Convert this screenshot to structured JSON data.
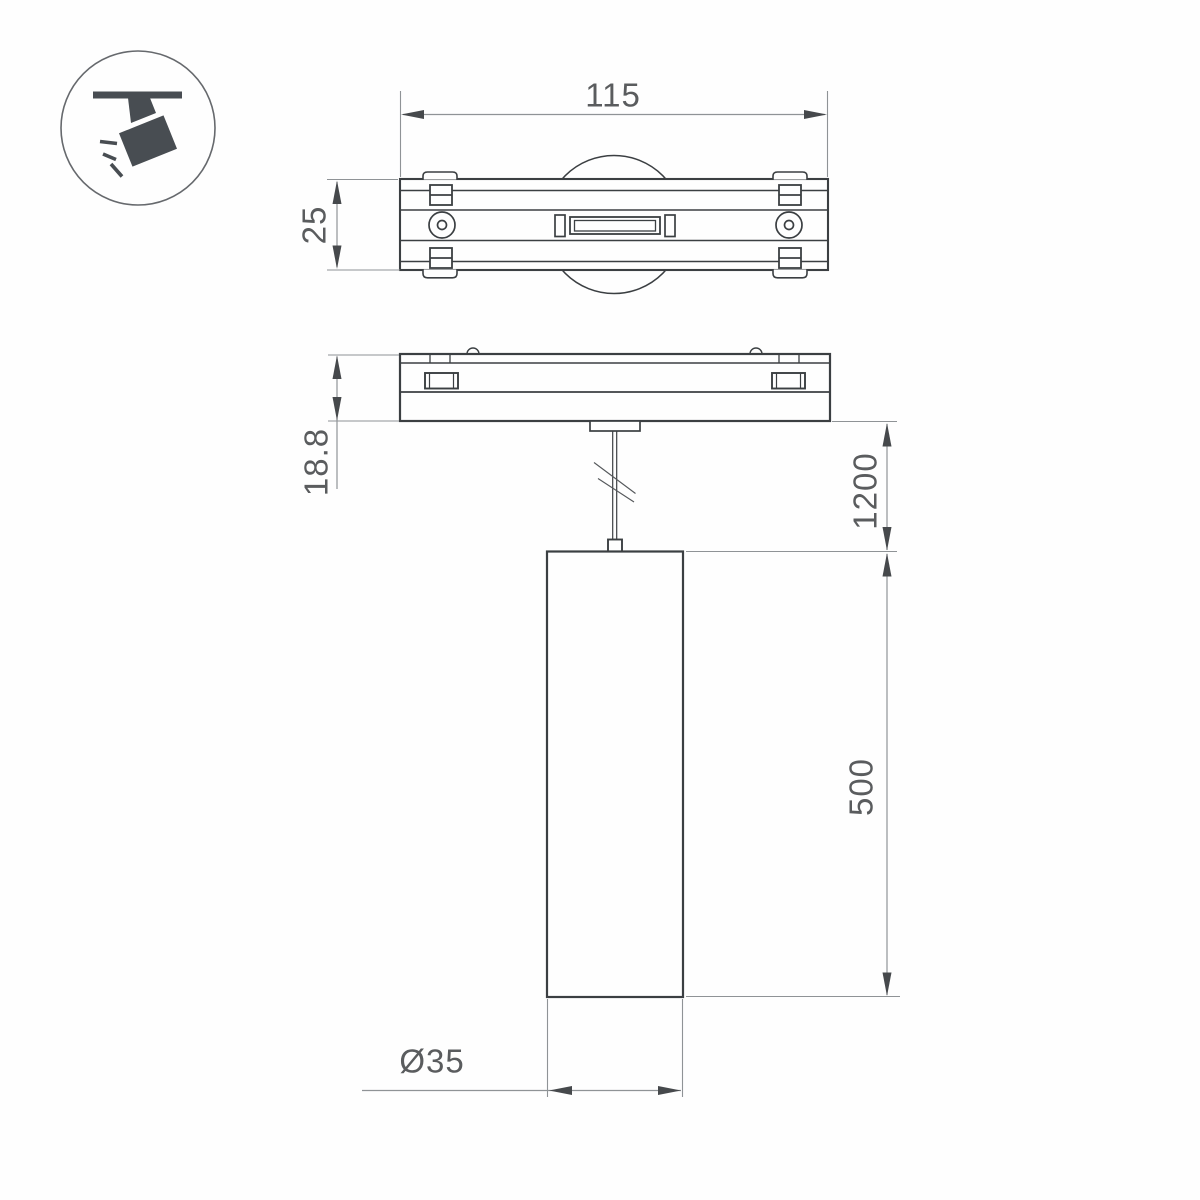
{
  "drawing_title": "pendant-track-light-technical-drawing",
  "colors": {
    "line": "#3b3f42",
    "dim_line": "#8f9396",
    "arrow": "#46494c",
    "text": "#5a5c5e",
    "icon": "#484d52",
    "background": "#fefefe"
  },
  "icon": {
    "label": "track-spotlight"
  },
  "dimensions": {
    "track_width": "115",
    "track_depth": "25",
    "adapter_height": "18.8",
    "suspension_length": "1200",
    "pendant_height": "500",
    "pendant_diameter": "Ø35"
  }
}
